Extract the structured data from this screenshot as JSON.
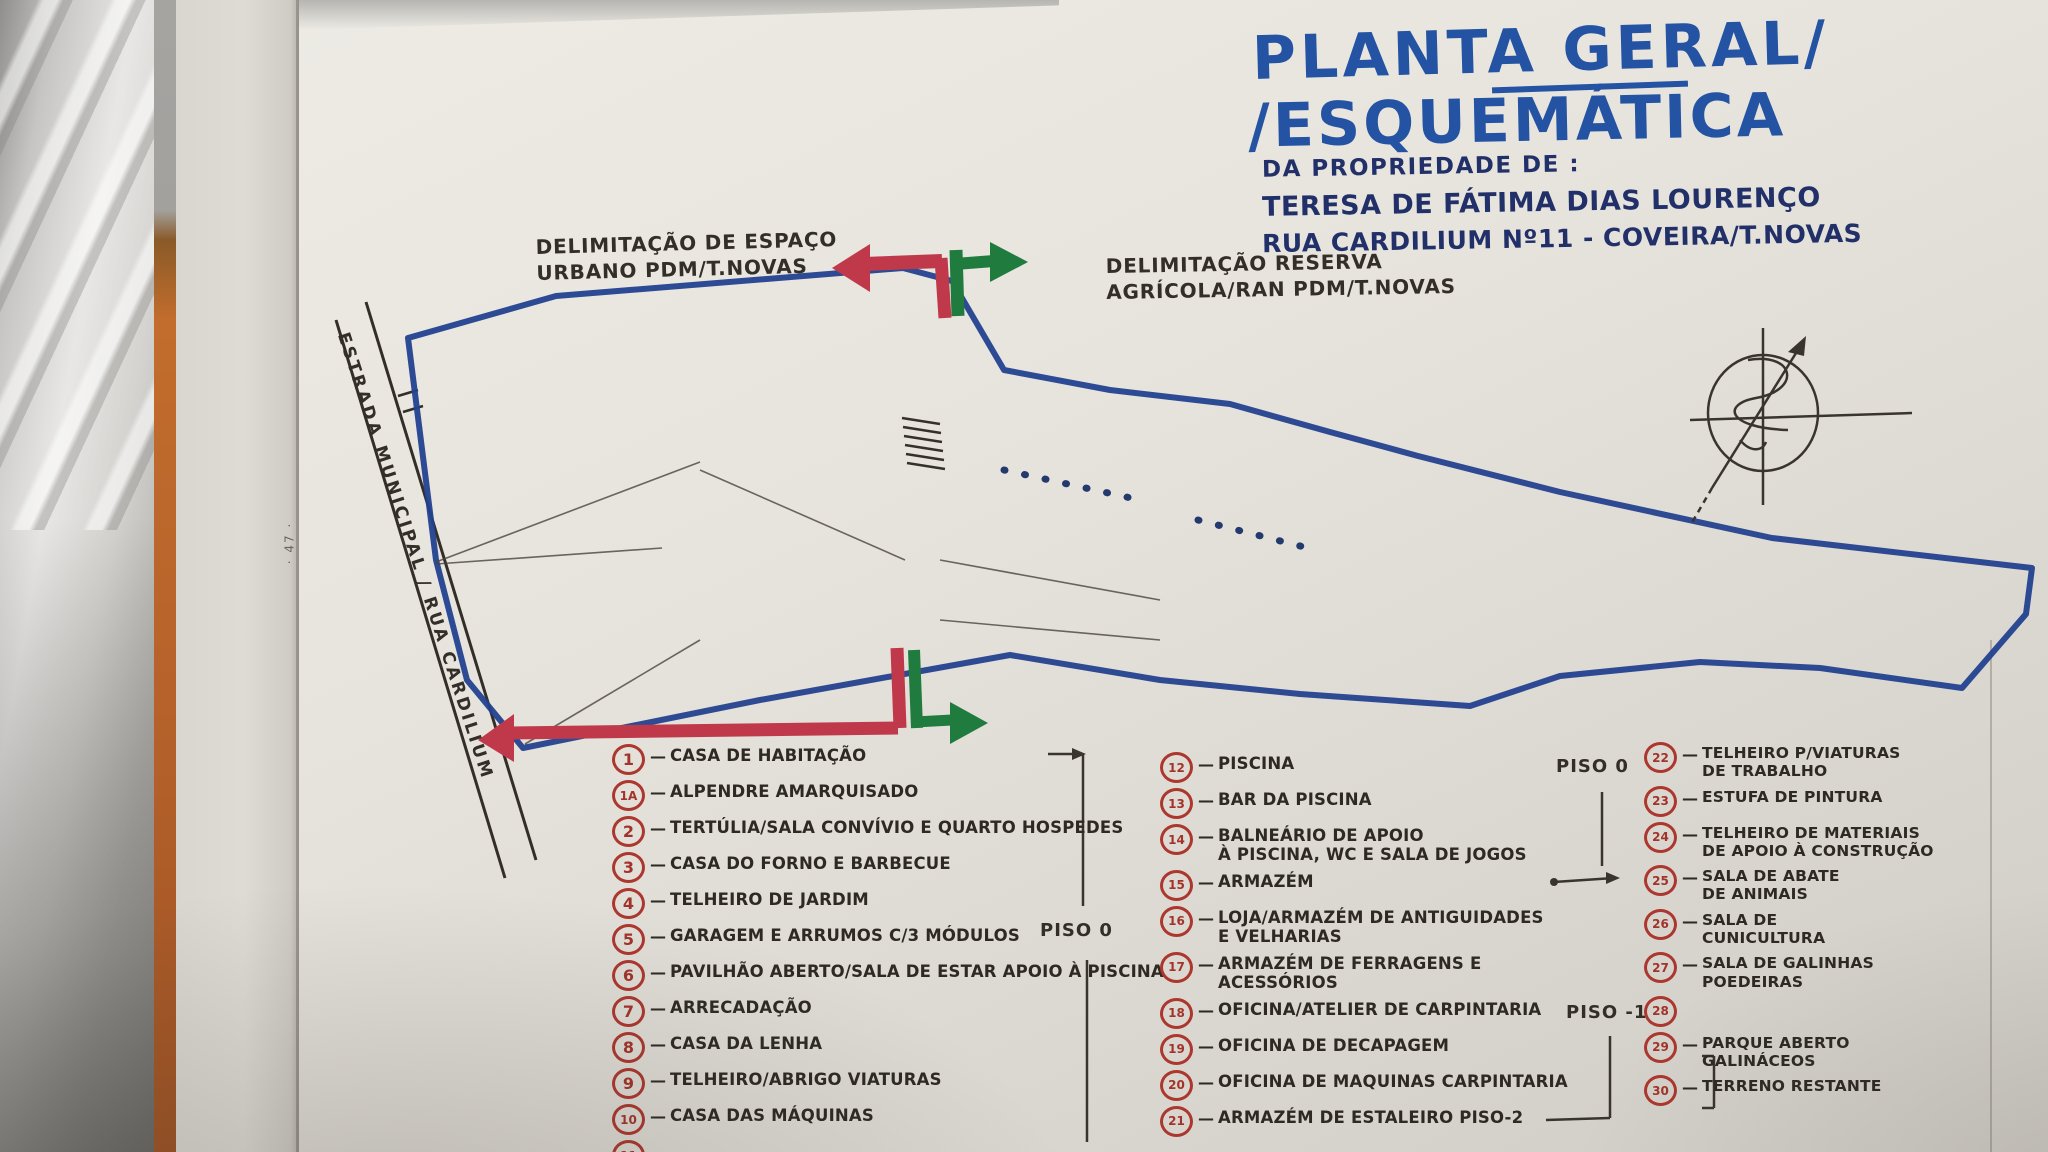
{
  "page_number": "· 47 ·",
  "title": {
    "line1": "PLANTA GERAL/",
    "line2": "/ESQUEMÁTICA",
    "line3": "DA PROPRIEDADE DE :",
    "line4": "TERESA DE FÁTIMA DIAS LOURENÇO",
    "line5": "RUA CARDILIUM Nº11 - COVEIRA/T.NOVAS"
  },
  "annotations": {
    "urban_limit": "DELIMITAÇÃO DE ESPAÇO\nURBANO PDM/T.NOVAS",
    "agricultural_limit": "DELIMITAÇÃO RESERVA\nAGRÍCOLA/RAN PDM/T.NOVAS",
    "road": "ESTRADA MUNICIPAL / RUA CARDILIUM",
    "piso0_left": "PISO 0",
    "piso0_right": "PISO 0",
    "piso_minus1": "PISO -1"
  },
  "colors": {
    "title_blue": "#2353a2",
    "navy": "#22306a",
    "marker_red": "#c0394a",
    "marker_green": "#207b3e",
    "boundary_blue": "#23418f",
    "ink": "#2e2a23",
    "yellow_building": "#cfa64c",
    "orange_building": "#c2591f",
    "pool_blue": "#2b96c8",
    "brown_building": "#6f3118",
    "green_building": "#1e7d38",
    "legend_red": "#ac372e"
  },
  "plan": {
    "buildings": [
      {
        "n": "",
        "c": "yellow",
        "x": 412,
        "y": 326,
        "w": 146,
        "h": 160,
        "r": -4,
        "circ": true
      },
      {
        "n": "",
        "c": "wall",
        "x": 457,
        "y": 328,
        "w": 5,
        "h": 156,
        "r": -4,
        "circ": false
      },
      {
        "n": "",
        "c": "wall",
        "x": 503,
        "y": 327,
        "w": 5,
        "h": 156,
        "r": -4,
        "circ": false
      },
      {
        "n": "1",
        "c": "none",
        "x": 446,
        "y": 378,
        "w": 50,
        "h": 50,
        "r": 0,
        "circ": true
      },
      {
        "n": "1A",
        "c": "none",
        "x": 504,
        "y": 372,
        "w": 56,
        "h": 50,
        "r": -10,
        "circ": true
      },
      {
        "n": "4",
        "c": "yellow",
        "x": 583,
        "y": 324,
        "w": 74,
        "h": 66,
        "r": 6,
        "circ": true
      },
      {
        "n": "6",
        "c": "yellow",
        "x": 756,
        "y": 332,
        "w": 76,
        "h": 62,
        "r": 4,
        "circ": true
      },
      {
        "n": "13",
        "c": "yellow",
        "x": 842,
        "y": 336,
        "w": 52,
        "h": 54,
        "r": -8,
        "circ": true
      },
      {
        "n": "12",
        "c": "pool",
        "x": 828,
        "y": 388,
        "w": 58,
        "h": 80,
        "r": 7,
        "circ": false
      },
      {
        "n": "14",
        "c": "yellow",
        "x": 946,
        "y": 374,
        "w": 48,
        "h": 56,
        "r": 8,
        "circ": false
      },
      {
        "n": "15",
        "c": "orange",
        "x": 924,
        "y": 426,
        "w": 80,
        "h": 110,
        "r": 8,
        "circ": true
      },
      {
        "n": "16",
        "c": "orange",
        "x": 1006,
        "y": 356,
        "w": 190,
        "h": 100,
        "r": 9,
        "circ": true
      },
      {
        "n": "17",
        "c": "orange",
        "x": 1162,
        "y": 428,
        "w": 34,
        "h": 52,
        "r": 10,
        "circ": false
      },
      {
        "n": "18",
        "c": "orange",
        "x": 1196,
        "y": 438,
        "w": 50,
        "h": 58,
        "r": 10,
        "circ": true
      },
      {
        "n": "19",
        "c": "orange",
        "x": 1244,
        "y": 450,
        "w": 42,
        "h": 54,
        "r": 10,
        "circ": true
      },
      {
        "n": "20",
        "c": "orange",
        "x": 1286,
        "y": 460,
        "w": 54,
        "h": 58,
        "r": 10,
        "circ": true
      },
      {
        "n": "21",
        "c": "hatcho",
        "x": 1318,
        "y": 498,
        "w": 64,
        "h": 92,
        "r": 10,
        "circ": true
      },
      {
        "n": "23",
        "c": "hatcho",
        "x": 1378,
        "y": 478,
        "w": 54,
        "h": 58,
        "r": 10,
        "circ": true
      },
      {
        "n": "22",
        "c": "hatcho",
        "x": 1360,
        "y": 546,
        "w": 60,
        "h": 62,
        "r": 10,
        "circ": true
      },
      {
        "n": "24",
        "c": "hatcho",
        "x": 1438,
        "y": 504,
        "w": 64,
        "h": 62,
        "r": 10,
        "circ": true
      },
      {
        "n": "25",
        "c": "brown",
        "x": 1642,
        "y": 518,
        "w": 54,
        "h": 42,
        "r": 8,
        "circ": false
      },
      {
        "n": "26",
        "c": "brown",
        "x": 1638,
        "y": 558,
        "w": 56,
        "h": 44,
        "r": 8,
        "circ": false
      },
      {
        "n": "28",
        "c": "brown",
        "x": 1698,
        "y": 532,
        "w": 54,
        "h": 64,
        "r": 8,
        "circ": false
      },
      {
        "n": "27",
        "c": "olive",
        "x": 1630,
        "y": 604,
        "w": 60,
        "h": 48,
        "r": 8,
        "circ": false
      },
      {
        "n": "29",
        "c": "green",
        "x": 1698,
        "y": 598,
        "w": 64,
        "h": 54,
        "r": 8,
        "circ": false
      },
      {
        "n": "30",
        "c": "hatchg",
        "x": 1766,
        "y": 546,
        "w": 206,
        "h": 132,
        "r": 3,
        "circ": false
      },
      {
        "n": "3",
        "c": "yellow",
        "x": 586,
        "y": 453,
        "w": 64,
        "h": 74,
        "r": 35,
        "circ": true
      },
      {
        "n": "5",
        "c": "yellow",
        "x": 620,
        "y": 468,
        "w": 68,
        "h": 80,
        "r": 35,
        "circ": true
      },
      {
        "n": "7",
        "c": "yellow",
        "x": 750,
        "y": 450,
        "w": 54,
        "h": 42,
        "r": 10,
        "circ": true
      },
      {
        "n": "9",
        "c": "yellow",
        "x": 744,
        "y": 484,
        "w": 94,
        "h": 64,
        "r": 6,
        "circ": true
      },
      {
        "n": "10",
        "c": "yellow",
        "x": 838,
        "y": 490,
        "w": 32,
        "h": 46,
        "r": 6,
        "circ": false
      },
      {
        "n": "11",
        "c": "yellow",
        "x": 870,
        "y": 492,
        "w": 32,
        "h": 46,
        "r": 6,
        "circ": false
      },
      {
        "n": "2",
        "c": "yellow",
        "x": 496,
        "y": 594,
        "w": 74,
        "h": 68,
        "r": -35,
        "circ": true
      },
      {
        "n": "2A",
        "c": "yellow",
        "x": 558,
        "y": 564,
        "w": 74,
        "h": 68,
        "r": -35,
        "circ": true
      },
      {
        "n": "8",
        "c": "orange",
        "x": 836,
        "y": 593,
        "w": 68,
        "h": 54,
        "r": 4,
        "circ": true
      }
    ],
    "labels": [
      {
        "top": "PLATAFORMA",
        "num": "1",
        "bottom": "",
        "x": 614,
        "y": 398,
        "w": 130,
        "r": -2,
        "small": false
      },
      {
        "top": "PLATAFORMA",
        "num": "1",
        "bottom": "\"PISO 0\"",
        "x": 706,
        "y": 552,
        "w": 130,
        "r": -2,
        "small": false
      },
      {
        "top": "PLATAFORMA",
        "num": "2",
        "bottom": "PISO-1",
        "x": 1082,
        "y": 496,
        "w": 136,
        "r": -3,
        "small": false
      },
      {
        "top": "PLATAF.",
        "num": "3",
        "bottom": "PISO-2",
        "x": 1284,
        "y": 606,
        "w": 84,
        "r": -3,
        "small": true
      },
      {
        "top": "PLATAFORMA",
        "num": "4",
        "bottom": "PISO-3",
        "x": 1412,
        "y": 570,
        "w": 136,
        "r": -8,
        "small": false
      }
    ]
  },
  "legend": {
    "columns": [
      [
        {
          "n": "1",
          "t": "CASA DE HABITAÇÃO"
        },
        {
          "n": "1A",
          "t": "ALPENDRE AMARQUISADO"
        },
        {
          "n": "2",
          "t": "TERTÚLIA/SALA CONVÍVIO E QUARTO HOSPEDES"
        },
        {
          "n": "3",
          "t": "CASA DO FORNO E BARBECUE"
        },
        {
          "n": "4",
          "t": "TELHEIRO DE JARDIM"
        },
        {
          "n": "5",
          "t": "GARAGEM E ARRUMOS C/3 MÓDULOS"
        },
        {
          "n": "6",
          "t": "PAVILHÃO ABERTO/SALA DE ESTAR APOIO À PISCINA"
        },
        {
          "n": "7",
          "t": "ARRECADAÇÃO"
        },
        {
          "n": "8",
          "t": "CASA DA LENHA"
        },
        {
          "n": "9",
          "t": "TELHEIRO/ABRIGO VIATURAS"
        },
        {
          "n": "10",
          "t": "CASA DAS MÁQUINAS"
        },
        {
          "n": "11",
          "t": ""
        }
      ],
      [
        {
          "n": "12",
          "t": "PISCINA"
        },
        {
          "n": "13",
          "t": "BAR DA PISCINA"
        },
        {
          "n": "14",
          "t": "BALNEÁRIO DE APOIO\nÀ PISCINA, WC E SALA DE JOGOS"
        },
        {
          "n": "15",
          "t": "ARMAZÉM"
        },
        {
          "n": "16",
          "t": "LOJA/ARMAZÉM DE ANTIGUIDADES\nE VELHARIAS"
        },
        {
          "n": "17",
          "t": "ARMAZÉM DE FERRAGENS E ACESSÓRIOS"
        },
        {
          "n": "18",
          "t": "OFICINA/ATELIER DE CARPINTARIA"
        },
        {
          "n": "19",
          "t": "OFICINA DE DECAPAGEM"
        },
        {
          "n": "20",
          "t": "OFICINA DE MAQUINAS CARPINTARIA"
        },
        {
          "n": "21",
          "t": "ARMAZÉM DE ESTALEIRO PISO-2"
        }
      ],
      [
        {
          "n": "22",
          "t": "TELHEIRO P/VIATURAS\nDE TRABALHO"
        },
        {
          "n": "23",
          "t": "ESTUFA DE PINTURA"
        },
        {
          "n": "24",
          "t": "TELHEIRO DE MATERIAIS\nDE APOIO À CONSTRUÇÃO"
        },
        {
          "n": "25",
          "t": "SALA DE ABATE\nDE ANIMAIS"
        },
        {
          "n": "26",
          "t": "SALA DE\nCUNICULTURA"
        },
        {
          "n": "27",
          "t": "SALA DE GALINHAS\nPOEDEIRAS"
        },
        {
          "n": "28",
          "t": ""
        },
        {
          "n": "29",
          "t": "PARQUE ABERTO\nGALINÁCEOS"
        },
        {
          "n": "30",
          "t": "TERRENO RESTANTE"
        }
      ]
    ]
  }
}
